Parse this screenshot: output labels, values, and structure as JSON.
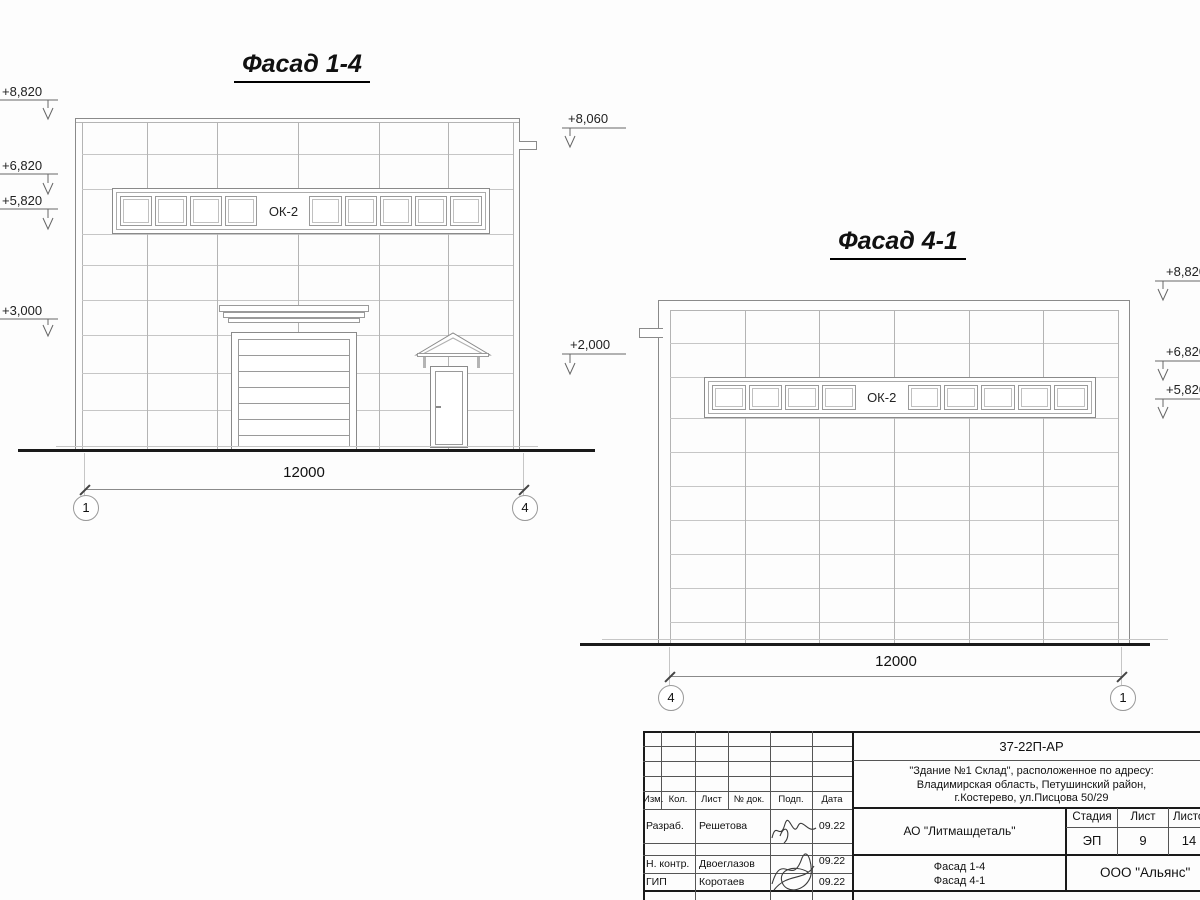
{
  "titles": {
    "left": "Фасад 1-4",
    "right": "Фасад 4-1"
  },
  "left_facade": {
    "window_label": "ОК-2",
    "dimension": "12000",
    "axis_left": "1",
    "axis_right": "4",
    "elev_left": [
      "+8,820",
      "+6,820",
      "+5,820",
      "+3,000"
    ],
    "elev_right": [
      "+8,060",
      "+2,000"
    ]
  },
  "right_facade": {
    "window_label": "ОК-2",
    "dimension": "12000",
    "axis_left": "4",
    "axis_right": "1",
    "elev_right": [
      "+8,820",
      "+6,820",
      "+5,820"
    ]
  },
  "title_block": {
    "doc_number": "37-22П-АР",
    "address": [
      "\"Здание №1 Склад\", расположенное по адресу:",
      "Владимирская область, Петушинский район,",
      "г.Костерево, ул.Писцова 50/29"
    ],
    "rev_cols": [
      "Изм.",
      "Кол.",
      "Лист",
      "№ док.",
      "Подп.",
      "Дата"
    ],
    "staff": [
      {
        "role": "Разраб.",
        "name": "Решетова",
        "date": "09.22"
      },
      {
        "role": "Н. контр.",
        "name": "Двоеглазов",
        "date": "09.22"
      },
      {
        "role": "ГИП",
        "name": "Коротаев",
        "date": "09.22"
      }
    ],
    "client": "АО \"Литмашдеталь\"",
    "stage_cols": [
      "Стадия",
      "Лист",
      "Листов"
    ],
    "stage": "ЭП",
    "sheet": "9",
    "sheets": "14",
    "sheet_title": [
      "Фасад 1-4",
      "Фасад 4-1"
    ],
    "organization": "ООО \"Альянс\""
  }
}
